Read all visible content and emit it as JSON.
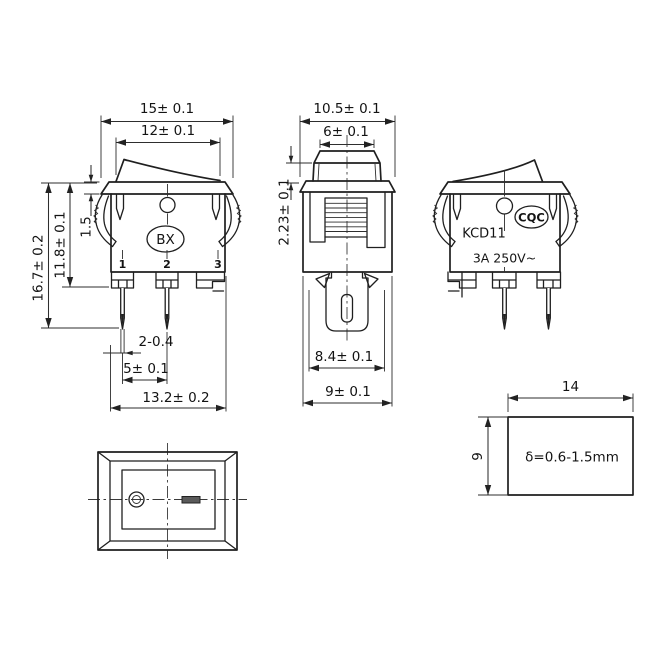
{
  "front_view": {
    "brand": "BX",
    "pin_labels": [
      "1",
      "2",
      "3"
    ],
    "dims": {
      "width_top": "15± 0.1",
      "width_rocker": "12± 0.1",
      "flange_thickness": "1.5",
      "height_body": "11.8± 0.1",
      "height_total": "16.7± 0.2",
      "pin_thickness": "2-0.4",
      "pin_pitch": "5± 0.1",
      "width_bottom": "13.2± 0.2"
    }
  },
  "side_view": {
    "dims": {
      "width_top": "10.5± 0.1",
      "width_rocker": "6± 0.1",
      "rocker_height": "2.23± 0.1",
      "width_inner": "8.4± 0.1",
      "width_body": "9± 0.1"
    }
  },
  "rear_view": {
    "cert_mark": "CQC",
    "model": "KCD11",
    "rating": "3A 250V~"
  },
  "panel_cutout": {
    "dims": {
      "width": "14",
      "height": "9"
    },
    "thickness_note": "δ=0.6-1.5mm"
  }
}
